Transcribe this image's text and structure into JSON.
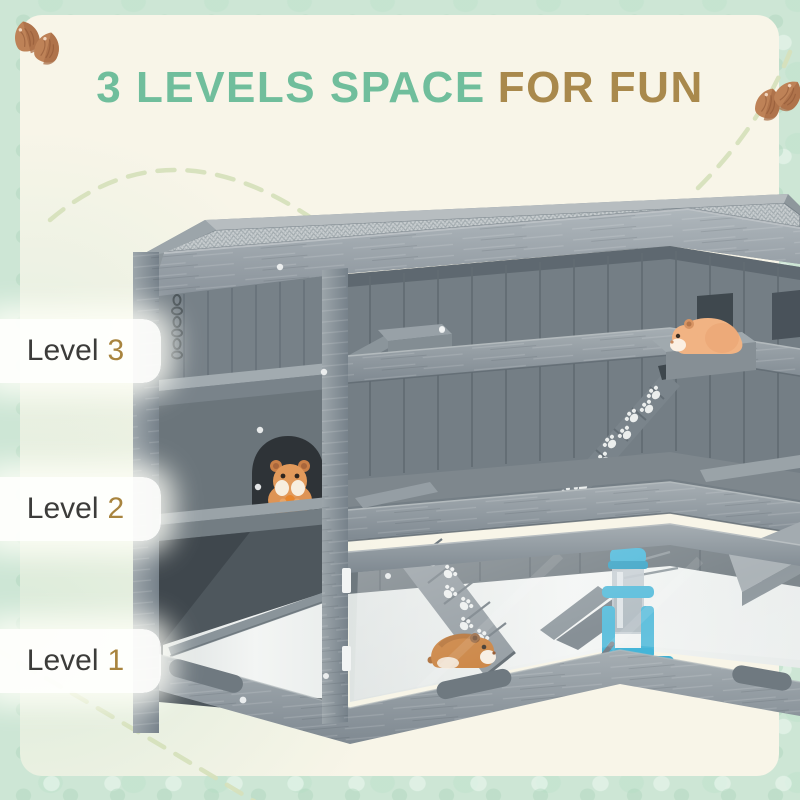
{
  "title": {
    "main": "3 LEVELS SPACE",
    "accent": "FOR FUN"
  },
  "levels": [
    {
      "label": "Level",
      "number": "3"
    },
    {
      "label": "Level",
      "number": "2"
    },
    {
      "label": "Level",
      "number": "1"
    }
  ],
  "colors": {
    "title_main": "#70BE9C",
    "title_accent": "#A9894C",
    "level_label": "#3C3C3A",
    "level_number": "#A8843E",
    "panel_cream": "#F8F5E8",
    "border_mint": "#CDE6D5",
    "dash_arc": "#D6E0BC",
    "cage_gray": "#8E979C",
    "hamster_orange": "#E8A86B",
    "bottle_blue": "#4FB9D9"
  },
  "decorations": {
    "top_left_icon": "almond-seeds-icon",
    "top_right_icon": "almond-seeds-icon",
    "arc_style": "dashed-arc-decoration"
  },
  "illustration": {
    "subject": "3-level wooden hamster cage with mesh top, paw-print ramps, three hamsters and a water bottle"
  }
}
